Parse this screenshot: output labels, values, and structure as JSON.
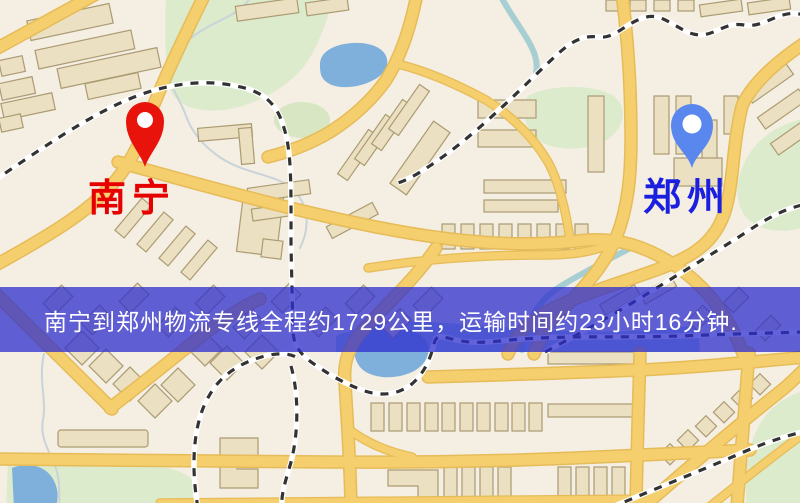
{
  "banner": {
    "text": "南宁到郑州物流专线全程约1729公里，运输时间约23小时16分钟.",
    "origin": "南宁",
    "destination": "郑州",
    "service_type": "物流专线",
    "distance_text": "约1729公里",
    "duration_text": "约23小时16分钟"
  },
  "map": {
    "markers": [
      {
        "name": "origin",
        "label": "南宁",
        "pin_icon": "red-map-pin-icon",
        "pin_color": "#e8140c",
        "label_color": "#e60000"
      },
      {
        "name": "destination",
        "label": "郑州",
        "pin_icon": "blue-map-pin-icon",
        "pin_color": "#5a87ee",
        "label_color": "#1a1fe0"
      }
    ],
    "style_colors": {
      "background": "#f4eee3",
      "road": "#f5ce6d",
      "road_casing": "#e6bc58",
      "building": "#ece0c2",
      "building_outline": "#ab9b72",
      "green_area": "#dcebcc",
      "water": "#7fafdb",
      "railway": "#333333",
      "banner_background": "rgba(45,45,205,0.75)",
      "banner_text": "#ffffff"
    }
  }
}
